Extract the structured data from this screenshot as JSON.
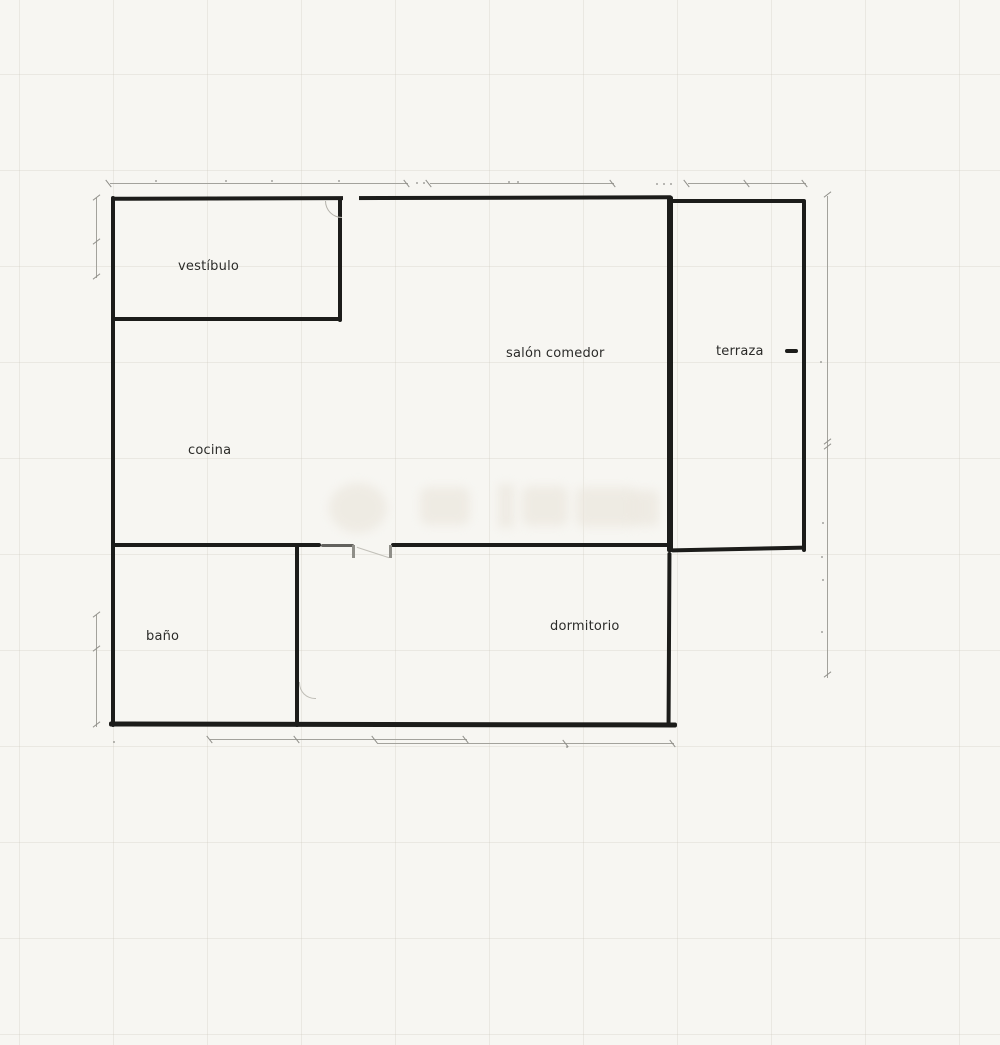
{
  "plan": {
    "type": "apartment-floor-plan",
    "rooms": [
      {
        "name": "vestibulo",
        "label": "vestíbulo"
      },
      {
        "name": "cocina",
        "label": "cocina"
      },
      {
        "name": "salon-comedor",
        "label": "salón comedor"
      },
      {
        "name": "terraza",
        "label": "terraza"
      },
      {
        "name": "bano",
        "label": "baño"
      },
      {
        "name": "dormitorio",
        "label": "dormitorio"
      }
    ],
    "colors": {
      "wall": "#1c1c1a",
      "dimension_line": "#a3a29c",
      "door_symbol": "#b9b7b0",
      "background": "#f7f6f2",
      "grid": "#ecebe6"
    },
    "notes": {
      "dimension_labels_legible": false,
      "watermark_legible": false
    }
  }
}
